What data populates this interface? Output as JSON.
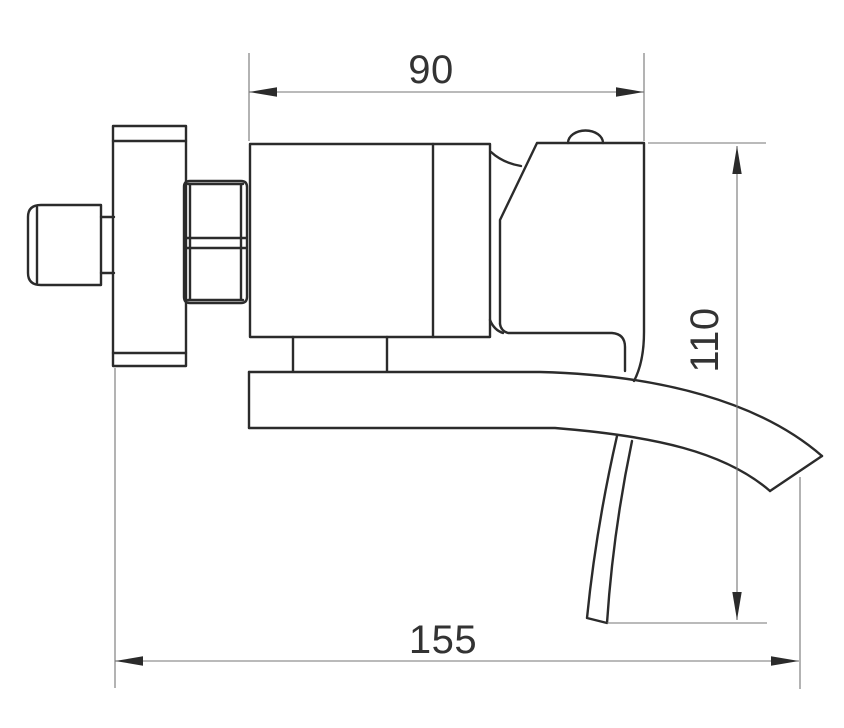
{
  "dimensions": {
    "top_width": {
      "label": "90",
      "orientation": "horizontal",
      "measures": "faucet body width"
    },
    "right_height": {
      "label": "110",
      "orientation": "vertical",
      "measures": "spout drop height"
    },
    "bottom_width": {
      "label": "155",
      "orientation": "horizontal",
      "measures": "overall projection"
    }
  },
  "colors": {
    "background": "#ffffff",
    "outline": "#2b2b2b",
    "dimension": "#757575",
    "label": "#333333"
  }
}
